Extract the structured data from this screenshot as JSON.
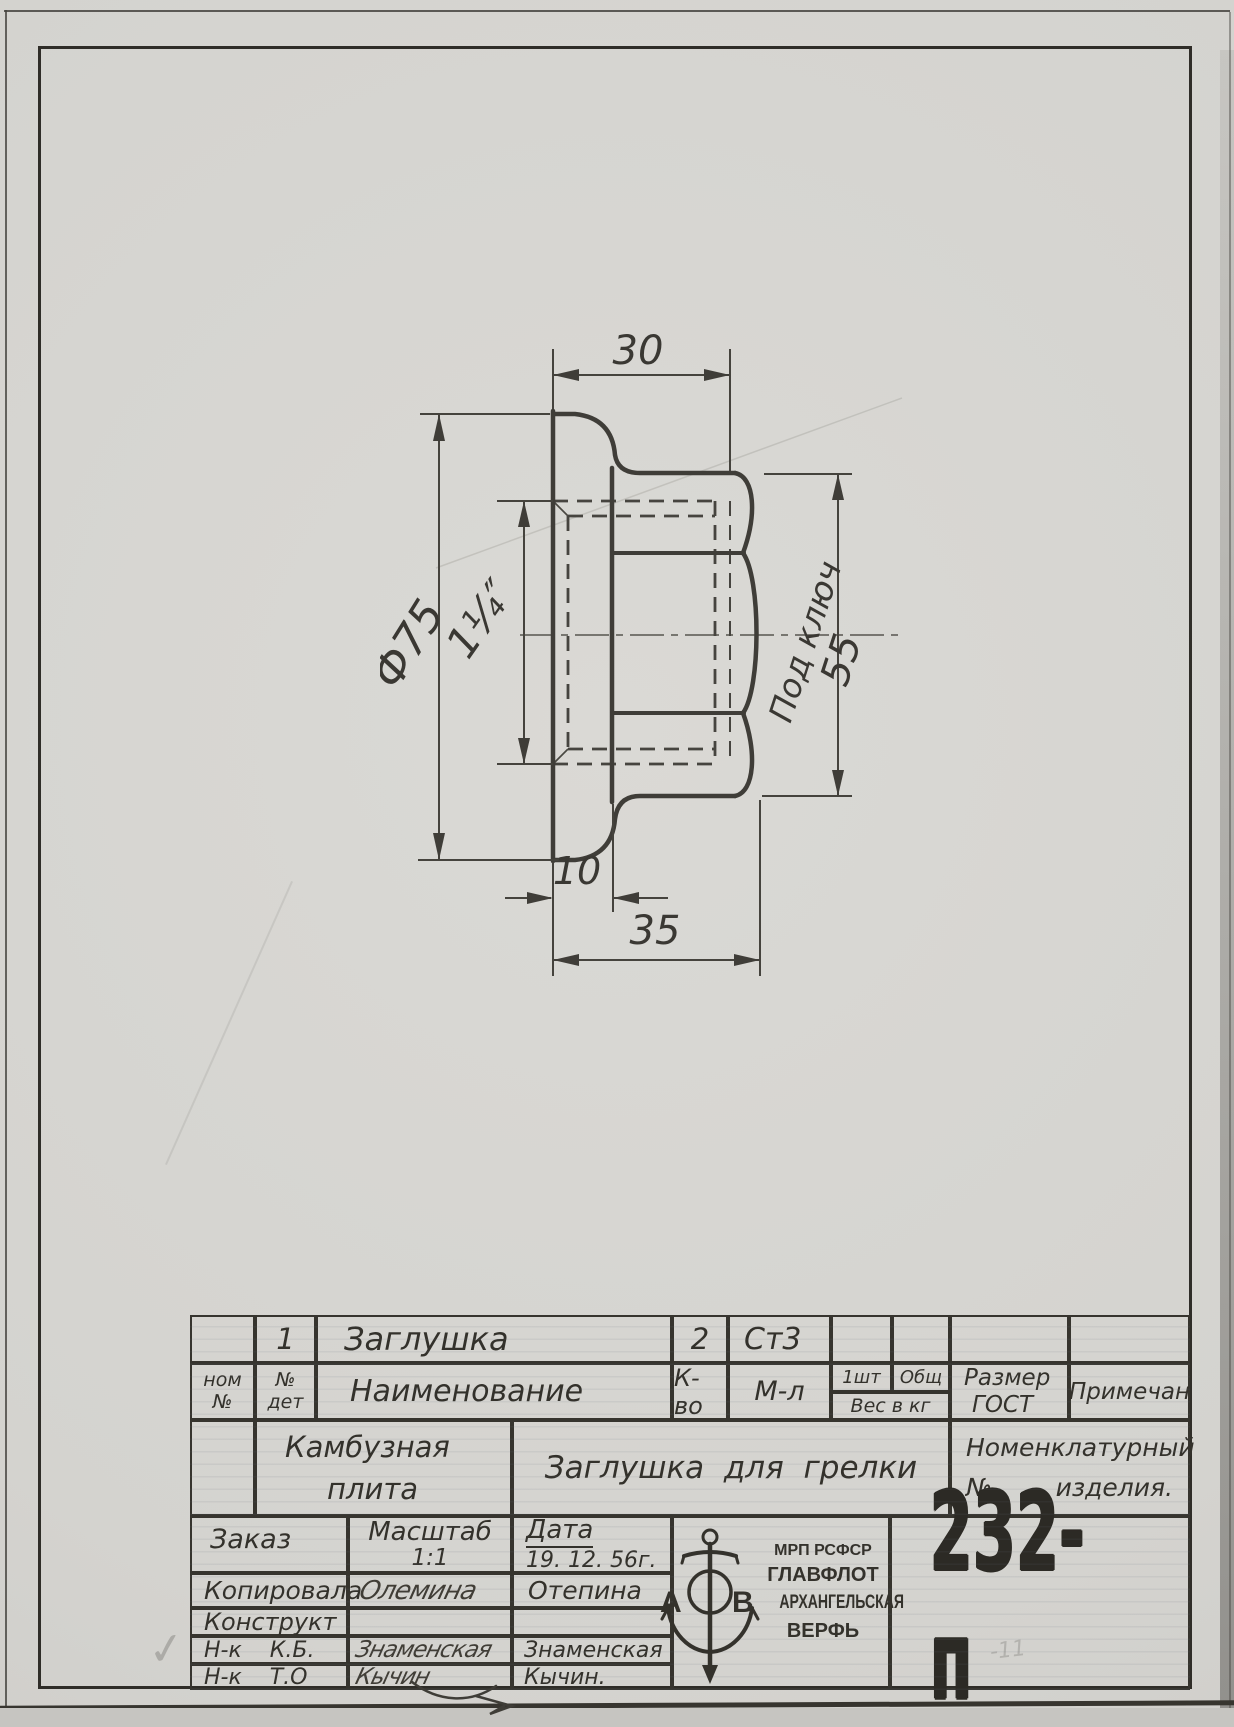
{
  "sheet": {
    "drawing_number": "232-п",
    "pencil_note": "-11",
    "check_mark": "✓"
  },
  "drawing": {
    "dim_top_width": "30",
    "dim_diameter": "Ф75",
    "dim_thread": "1¼″",
    "dim_wrench_label": "Под ключ",
    "dim_wrench_value": "55",
    "dim_flange_thickness": "10",
    "dim_total_length": "35"
  },
  "parts_table": {
    "item": {
      "det_no": "1",
      "name": "Заглушка",
      "qty": "2",
      "material": "Ст3"
    },
    "headers": {
      "nom_line1": "ном",
      "nom_line2": "№",
      "det_line1": "№",
      "det_line2": "дет",
      "name": "Наименование",
      "qty": "К-во",
      "material": "М-л",
      "per_item": "1шт",
      "total": "Общ",
      "weight": "Вес в кг",
      "size": "Размер",
      "gost": "ГОСТ",
      "note": "Примечан"
    }
  },
  "title_block": {
    "assembly_line1": "Камбузная",
    "assembly_line2": "плита",
    "part_title": "Заглушка  для  грелки",
    "nomenclature_line1": "Номенклатурный",
    "nomenclature_line2": "№        изделия.",
    "order_label": "Заказ",
    "scale_label": "Масштаб",
    "scale_value": "1:1",
    "date_label": "Дата",
    "date_value": "19. 12. 56г.",
    "copied_label": "Копировала",
    "copied_signature": "Олемина",
    "copied_name": "Отепина",
    "designer_label": "Конструкт",
    "chief_kb_label": "Н-к    К.Б.",
    "chief_kb_signature": "Знаменская",
    "chief_kb_name": "Знаменская",
    "chief_to_label": "Н-к    Т.О",
    "chief_to_signature": "Кычин",
    "chief_to_name": "Кычин."
  },
  "stamp": {
    "letter_a": "А",
    "letter_b": "В",
    "org_line1": "МРП РСФСР",
    "org_line2": "ГЛАВФЛОТ",
    "org_line3": "АРХАНГЕЛЬСКАЯ",
    "org_line4": "ВЕРФЬ"
  }
}
